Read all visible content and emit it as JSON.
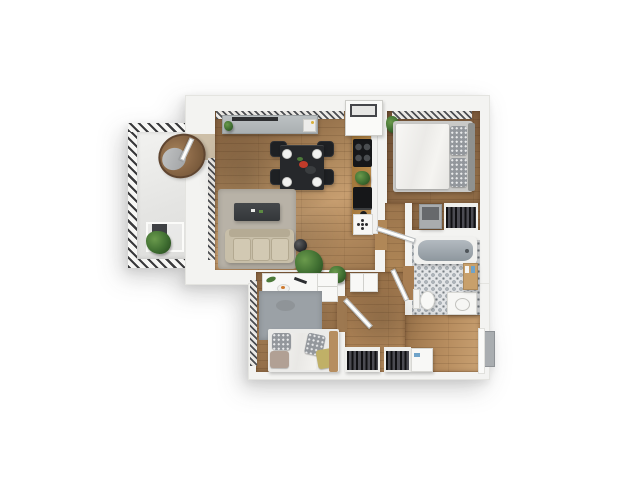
{
  "meta": {
    "title": "3D apartment floor plan render, top-down view",
    "canvas_width": 640,
    "canvas_height": 480
  },
  "scene": {
    "type": "3d-floor-plan-top-down-render",
    "rooms": [
      {
        "id": "balcony",
        "label": "Balcony",
        "floor": "light-concrete",
        "furniture": [
          "hanging-cocoon-chair",
          "seat-cushion",
          "planter-box",
          "potted-plant",
          "railing"
        ]
      },
      {
        "id": "living-room-kitchen",
        "label": "Living room with open kitchen",
        "floor": "wood-planks",
        "furniture": [
          "sideboard",
          "coffee-machine",
          "sideboard-plant",
          "dining-table",
          "dining-chair x4",
          "plate x4",
          "red-bowl",
          "serving-plate",
          "kitchen-counter",
          "cooktop",
          "counter-plant",
          "oven",
          "sink-cabinet",
          "area-rug",
          "tv-console",
          "sofa",
          "floor-lamp",
          "potted-plant",
          "entry-alcove"
        ]
      },
      {
        "id": "bedroom-1",
        "label": "Bedroom (top right)",
        "floor": "dark-wood-planks",
        "furniture": [
          "double-bed",
          "white-duvet",
          "patterned-pillow x2",
          "headboard",
          "corner-plant",
          "window-curtains"
        ]
      },
      {
        "id": "closet-nook",
        "label": "Closet nook",
        "floor": "wood-planks",
        "furniture": [
          "gray-cabinet",
          "open-wardrobe-rail"
        ]
      },
      {
        "id": "bathroom",
        "label": "Bathroom",
        "floor": "patterned-tile",
        "furniture": [
          "bathtub",
          "toilet",
          "washing-machine",
          "wood-storage-cabinet"
        ]
      },
      {
        "id": "hallway",
        "label": "Hallway",
        "floor": "wood-planks",
        "furniture": [
          "shelf-unit",
          "corner-plant",
          "open-wardrobe x2",
          "utility-box",
          "entry-door"
        ]
      },
      {
        "id": "bedroom-2",
        "label": "Bedroom (bottom left)",
        "floor": "wood-planks",
        "furniture": [
          "desk",
          "desk-chair",
          "desk-accessories",
          "shelf-return",
          "area-rug",
          "single-bed",
          "gray-pillow",
          "taupe-pillow",
          "patterned-pillow",
          "yellow-pillow",
          "wood-headboard",
          "window-curtains"
        ]
      }
    ],
    "doors": [
      "balcony-door",
      "living-to-corridor-door",
      "bathroom-door",
      "bedroom-2-door",
      "apartment-entry-door"
    ],
    "windows": [
      "living-top-wall",
      "living-left-wall",
      "bedroom-1-top-wall",
      "bedroom-2-left-wall"
    ]
  },
  "colors": {
    "wallFill": "#f3f3f1",
    "curtainDark": "#4c4e52",
    "woodLiving": "#b08a5e",
    "woodBedroom1": "#7d5b3c",
    "woodHall": "#a87e52",
    "woodBedroom2": "#9d7850",
    "balconyFloor": "#e9e9e7",
    "tileBase": "#e3e5e7",
    "rugLiving": "#b8b2a7",
    "rugBedroom2": "#9ba1a6",
    "sofaBeige": "#c8bfa9",
    "diningBlack": "#26282b",
    "counterWood": "#b68546",
    "applianceBlack": "#161719",
    "bedWhite": "#f4f3f1",
    "bedFrameGray": "#c9c9c7",
    "pillowGray": "#93979c",
    "pillowYellow": "#c0b067",
    "pillowTaupe": "#b1a094",
    "headboardWood": "#b68e60",
    "wardrobeSlat": "#2e2e34",
    "bathtubGray": "#98a1a8",
    "plantGreen": "#3f6e31",
    "hangingChairBrown": "#8a6847",
    "entryDoorGray": "#a9adb0",
    "accentRed": "#c23b2a",
    "accentYellowDot": "#d9b13b",
    "utilityLabelBlue": "#6fa3c9"
  }
}
